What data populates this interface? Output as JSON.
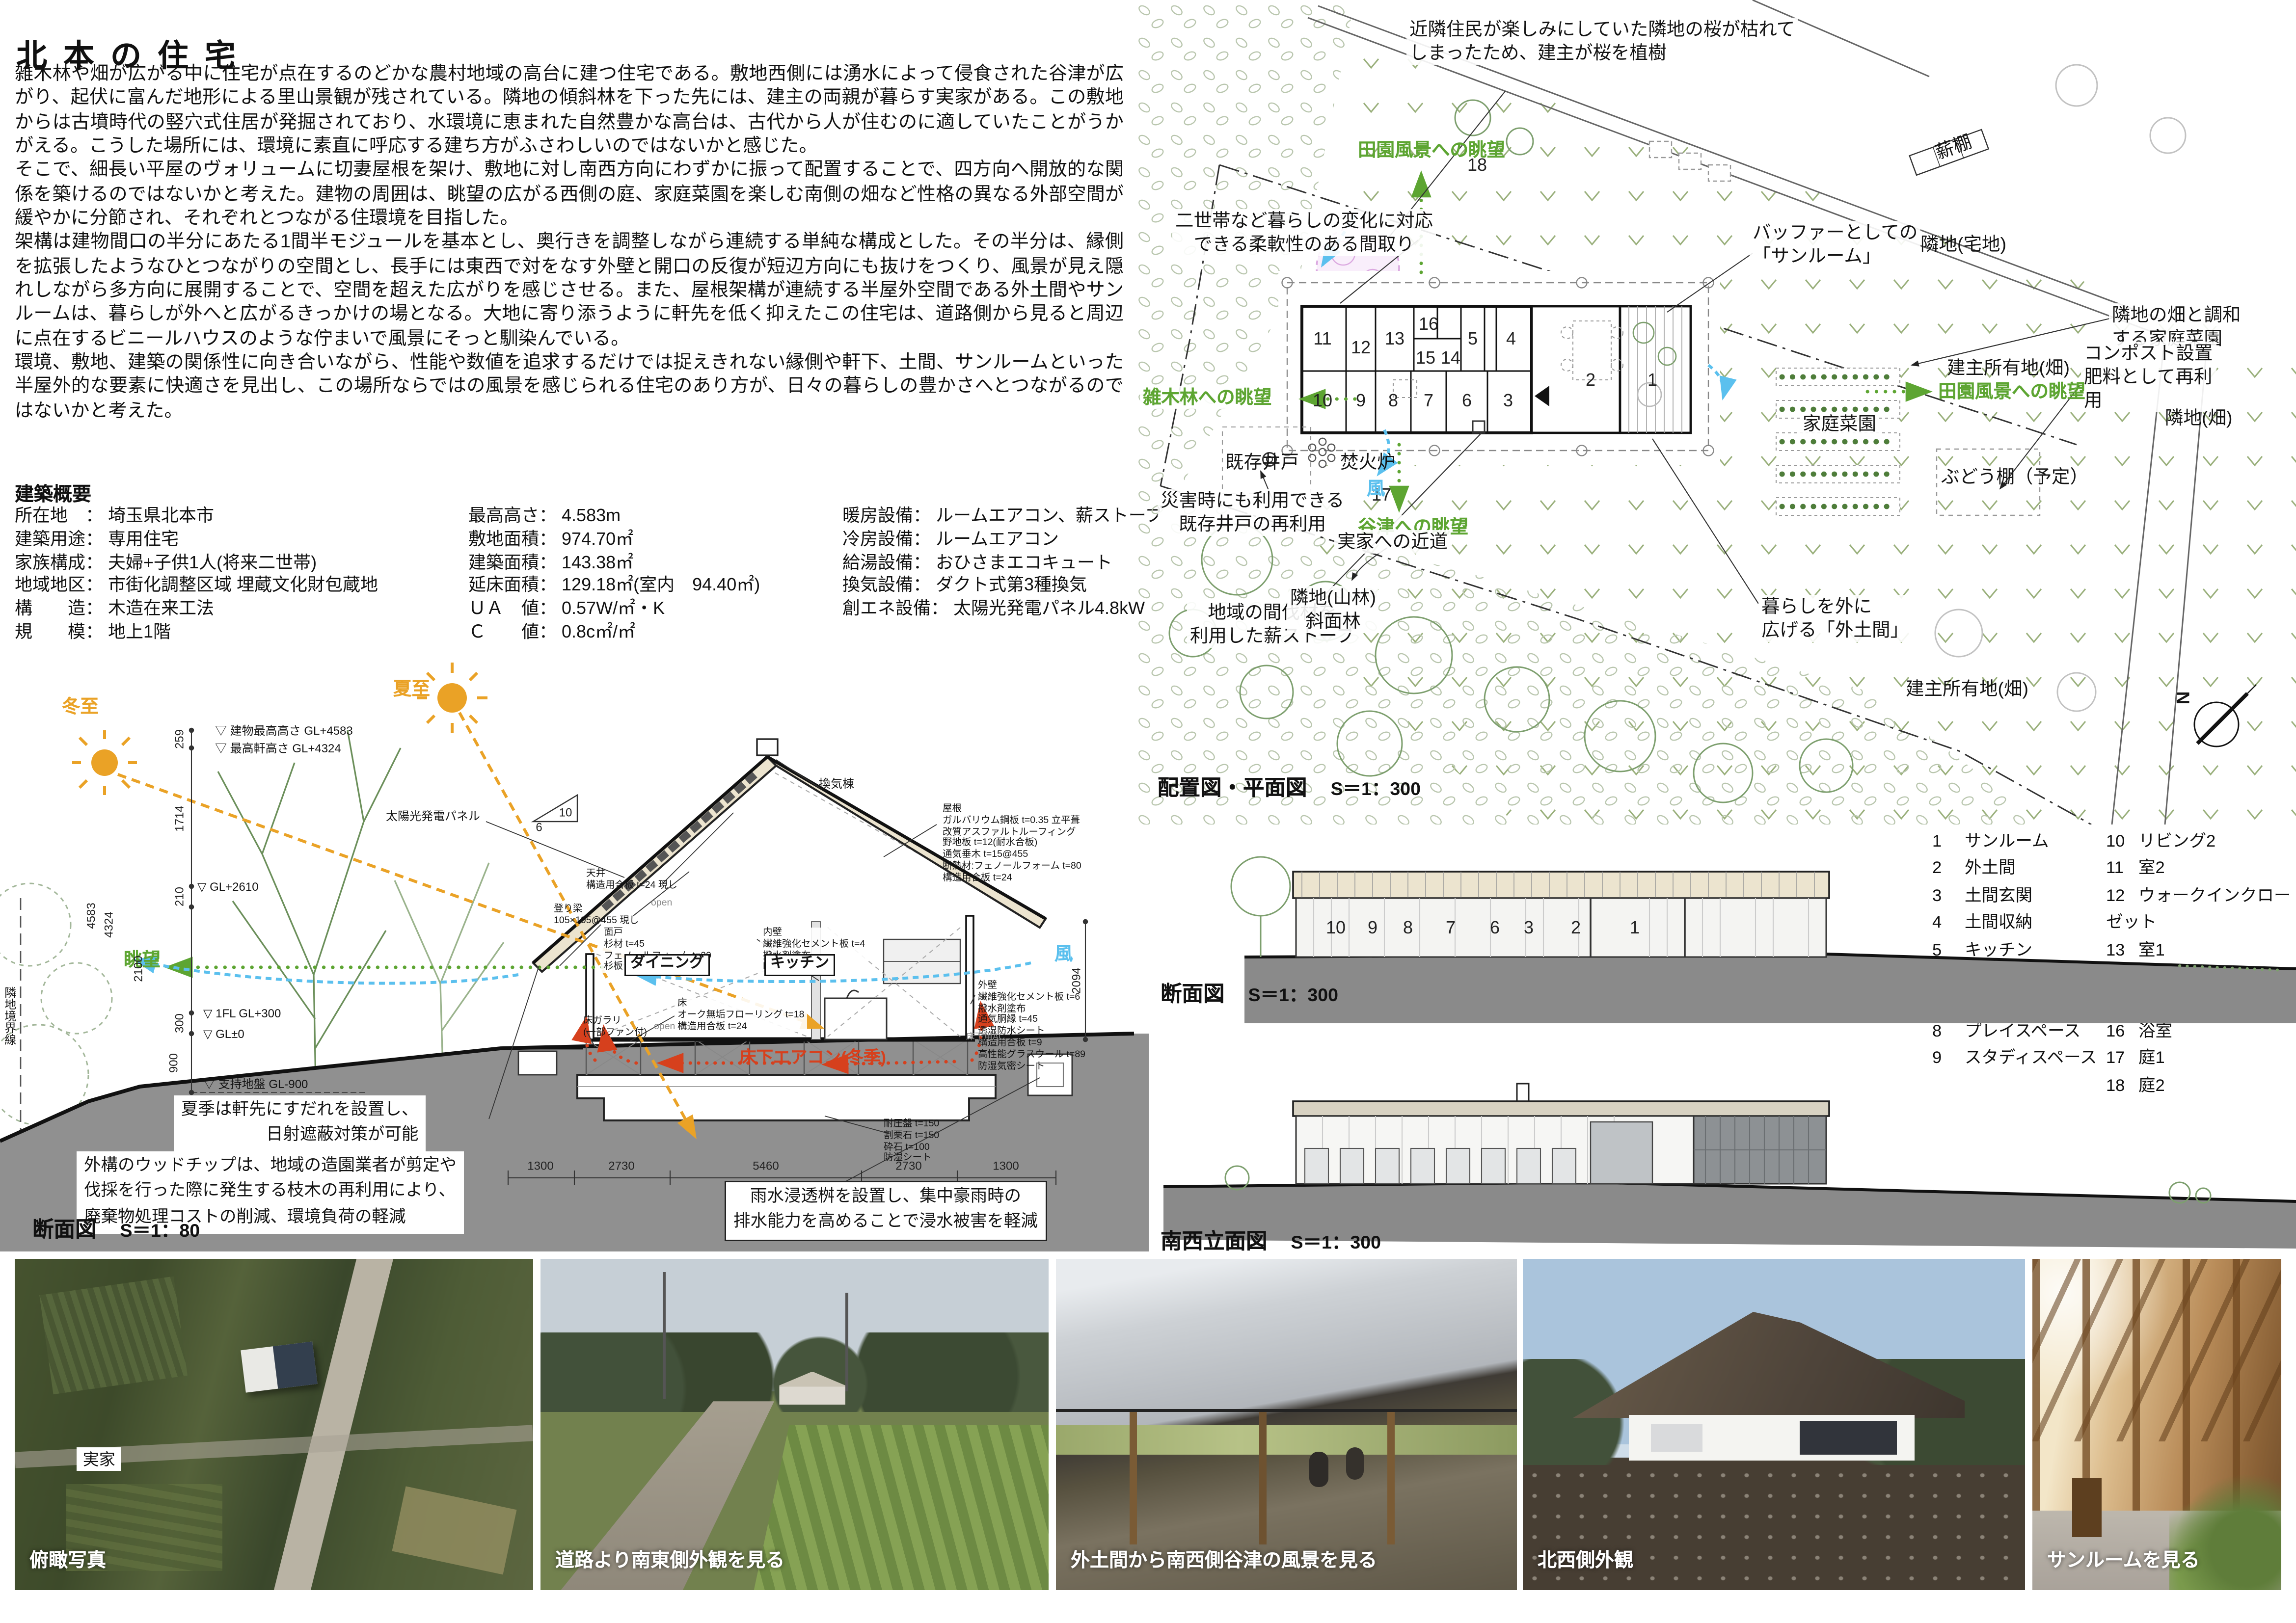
{
  "title": "北本の住宅",
  "intro": {
    "p1": "雑木林や畑が広がる中に住宅が点在するのどかな農村地域の高台に建つ住宅である。敷地西側には湧水によって侵食された谷津が広がり、起伏に富んだ地形による里山景観が残されている。隣地の傾斜林を下った先には、建主の両親が暮らす実家がある。この敷地からは古墳時代の竪穴式住居が発掘されており、水環境に恵まれた自然豊かな高台は、古代から人が住むのに適していたことがうかがえる。こうした場所には、環境に素直に呼応する建ち方がふさわしいのではないかと感じた。",
    "p2": "そこで、細長い平屋のヴォリュームに切妻屋根を架け、敷地に対し南西方向にわずかに振って配置することで、四方向へ開放的な関係を築けるのではないかと考えた。建物の周囲は、眺望の広がる西側の庭、家庭菜園を楽しむ南側の畑など性格の異なる外部空間が緩やかに分節され、それぞれとつながる住環境を目指した。",
    "p3": "架構は建物間口の半分にあたる1間半モジュールを基本とし、奥行きを調整しながら連続する単純な構成とした。その半分は、縁側を拡張したようなひとつながりの空間とし、長手には東西で対をなす外壁と開口の反復が短辺方向にも抜けをつくり、風景が見え隠れしながら多方向に展開することで、空間を超えた広がりを感じさせる。また、屋根架構が連続する半屋外空間である外土間やサンルームは、暮らしが外へと広がるきっかけの場となる。大地に寄り添うように軒先を低く抑えたこの住宅は、道路側から見ると周辺に点在するビニールハウスのような佇まいで風景にそっと馴染んでいる。",
    "p4": "環境、敷地、建築の関係性に向き合いながら、性能や数値を追求するだけでは捉えきれない縁側や軒下、土間、サンルームといった半屋外的な要素に快適さを見出し、この場所ならではの風景を感じられる住宅のあり方が、日々の暮らしの豊かさへとつながるのではないかと考えた。"
  },
  "overview": {
    "heading": "建築概要",
    "col1": [
      {
        "label": "所在地　： ",
        "value": "埼玉県北本市"
      },
      {
        "label": "建築用途： ",
        "value": "専用住宅"
      },
      {
        "label": "家族構成： ",
        "value": "夫婦+子供1人(将来二世帯)"
      },
      {
        "label": "地域地区： ",
        "value": "市街化調整区域 埋蔵文化財包蔵地"
      },
      {
        "label": "構　　造： ",
        "value": "木造在来工法"
      },
      {
        "label": "規　　模： ",
        "value": "地上1階"
      }
    ],
    "col2": [
      {
        "label": "最高高さ： ",
        "value": "4.583m"
      },
      {
        "label": "敷地面積： ",
        "value": "974.70㎡"
      },
      {
        "label": "建築面積： ",
        "value": "143.38㎡"
      },
      {
        "label": "延床面積： ",
        "value": "129.18㎡(室内　94.40㎡)"
      },
      {
        "label": "ＵＡ　値： ",
        "value": "0.57W/㎡・K"
      },
      {
        "label": "Ｃ　　値： ",
        "value": "0.8c㎡/㎡"
      }
    ],
    "col3": [
      {
        "label": "暖房設備： ",
        "value": "ルームエアコン、薪ストーブ"
      },
      {
        "label": "冷房設備： ",
        "value": "ルームエアコン"
      },
      {
        "label": "給湯設備： ",
        "value": "おひさまエコキュート"
      },
      {
        "label": "換気設備： ",
        "value": "ダクト式第3種換気"
      },
      {
        "label": "創エネ設備： ",
        "value": "太陽光発電パネル4.8kW"
      }
    ]
  },
  "section80": {
    "caption": "断面図",
    "scale": "S＝1：80",
    "labels": {
      "winter": "冬至",
      "summer": "夏至",
      "vent": "換気棟",
      "maxHeight": "▽ 建物最高高さ GL+4583",
      "eaveHeight": "▽ 最高軒高さ GL+4324",
      "gl2610": "▽ GL+2610",
      "solar": "太陽光発電パネル",
      "roofSpec": "屋根\nガルバリウム鋼板 t=0.35 立平葺\n改質アスファルトルーフィング\n野地板 t=12(耐水合板)\n通気垂木 t=15@455\n断熱材:フェノールフォーム t=80\n構造用合板 t=24",
      "ceiling": "天井\n構造用合板 t=24 現し",
      "beam": "登り梁\n105×105@455 現し",
      "mendo": "面戸\n杉材 t=45\nフェノールフォーム t=20\n杉板 t=12",
      "innerWall": "内壁\n繊維強化セメント板 t=4\n撥水剤塗布\nPB t=9.5下地",
      "outerWall": "外壁\n繊維強化セメント板 t=6\n撥水剤塗布\n通気胴縁 t=45\n透湿防水シート\n構造用合板 t=9\n高性能グラスウール t=89\n防湿気密シート",
      "floor": "床\nオーク無垢フローリング t=18\n構造用合板 t=24",
      "floorVent": "床ガラリ\n(一部ファン付)",
      "dining": "ダイニング",
      "kitchen": "キッチン",
      "open": "open",
      "view": "眺望",
      "wind": "風",
      "underfloorAC": "床下エアコン(冬季)",
      "acUnit": "床下用AC",
      "fl1": "▽ 1FL GL+300",
      "gl0": "▽ GL±0",
      "groundLv": "▽ 支持地盤 GL-900",
      "boundary": "隣地境界線",
      "slabNote": "耐圧盤 t=150\n割栗石 t=150\n砕石 t=100\n防湿シート",
      "sudare": "夏季は軒先にすだれを設置し、\n日射遮蔽対策が可能",
      "woodchip": "外構のウッドチップは、地域の造園業者が剪定や\n伐採を行った際に発生する枝木の再利用により、\n廃棄物処理コストの削減、環境負荷の軽減",
      "rainwater": "雨水浸透桝を設置し、集中豪雨時の\n排水能力を高めることで浸水被害を軽減",
      "slopeRun": "10",
      "slopeRise": "6"
    },
    "dims": {
      "d259": "259",
      "d1714": "1714",
      "d210": "210",
      "d300": "300",
      "d900": "900",
      "d2100": "2100",
      "d4324": "4324",
      "d4583": "4583",
      "d2094": "2094",
      "b1300a": "1300",
      "b2730a": "2730",
      "b5460": "5460",
      "b2730b": "2730",
      "b1300b": "1300"
    }
  },
  "sitePlan": {
    "caption": "配置図・平面図",
    "scale": "S＝1：300",
    "north": "N",
    "annotations": {
      "sakura": "近隣住民が楽しみにしていた隣地の桜が枯れて\nしまったため、建主が桜を植樹",
      "makidana": "薪棚",
      "rinchiTakuchi": "隣地(宅地)",
      "denenTop": "田園風景への眺望",
      "nisei": "二世帯など暮らしの変化に対応\nできる柔軟性のある間取り",
      "buffer": "バッファーとしての\n「サンルーム」",
      "rinchiHatakeWa": "隣地の畑と調和\nする家庭菜園",
      "compost": "コンポスト設置\n肥料として再利\n用",
      "kenshuUpper": "建主所有地(畑)",
      "denenRight": "田園風景への眺望",
      "kateisaien": "家庭菜園",
      "rinchiHatakeRight": "隣地(畑)",
      "budou": "ぶどう棚（予定）",
      "zoukibayashi": "雑木林への眺望",
      "kizonIdo": "既存井戸",
      "takibiro": "焚火炉",
      "saigai": "災害時にも利用できる\n既存井戸の再利用",
      "wind": "風",
      "yatsu": "谷津への眺望",
      "jikka": "実家への近道",
      "kanbatsu": "地域の間伐材を\n利用した薪ストーブ",
      "rinchiSanrin": "隣地(山林)\n斜面林",
      "kurashi": "暮らしを外に\n広げる「外土間」",
      "kenshuLower": "建主所有地(畑)"
    }
  },
  "legend": {
    "items": [
      {
        "num": "1",
        "label": "サンルーム"
      },
      {
        "num": "2",
        "label": "外土間"
      },
      {
        "num": "3",
        "label": "土間玄関"
      },
      {
        "num": "4",
        "label": "土間収納"
      },
      {
        "num": "5",
        "label": "キッチン"
      },
      {
        "num": "6",
        "label": "ダイニング"
      },
      {
        "num": "7",
        "label": "リビング1"
      },
      {
        "num": "8",
        "label": "プレイスペース"
      },
      {
        "num": "9",
        "label": "スタディスペース"
      },
      {
        "num": "10",
        "label": "リビング2"
      },
      {
        "num": "11",
        "label": "室2"
      },
      {
        "num": "12",
        "label": "ウォークインクローゼット"
      },
      {
        "num": "13",
        "label": "室1"
      },
      {
        "num": "14",
        "label": "洗面脱衣所"
      },
      {
        "num": "15",
        "label": "トイレ"
      },
      {
        "num": "16",
        "label": "浴室"
      },
      {
        "num": "17",
        "label": "庭1"
      },
      {
        "num": "18",
        "label": "庭2"
      }
    ]
  },
  "sec300": {
    "caption": "断面図",
    "scale": "S＝1：300",
    "numbers": [
      "10",
      "9",
      "8",
      "7",
      "6",
      "3",
      "2",
      "1"
    ]
  },
  "elev300": {
    "caption": "南西立面図",
    "scale": "S＝1：300"
  },
  "photos": [
    {
      "caption": "俯瞰写真"
    },
    {
      "caption": "道路より南東側外観を見る"
    },
    {
      "caption": "外土間から南西側谷津の風景を見る"
    },
    {
      "caption": "北西側外観"
    },
    {
      "caption": "サンルームを見る"
    }
  ],
  "photoTags": {
    "jikka": "実家"
  },
  "colors": {
    "annotationGreen": "#5da532",
    "windBlue": "#5bc0ee",
    "sunOrange": "#eaa226",
    "heatRed": "#d6401d",
    "groundGray": "#8f8f8f"
  }
}
